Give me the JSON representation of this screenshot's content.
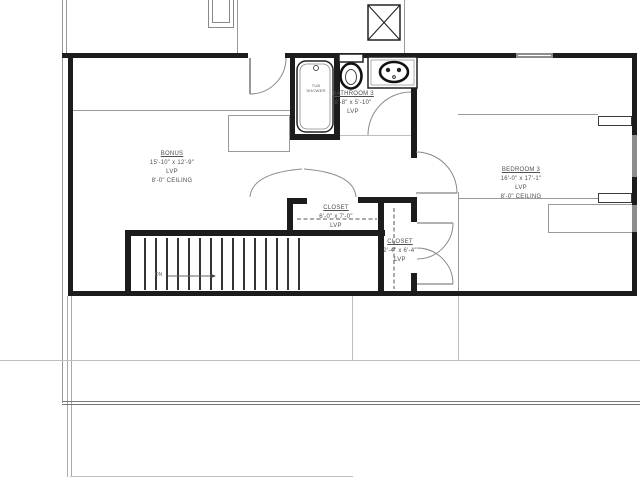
{
  "rooms": [
    {
      "name": "BONUS",
      "dimensions": "15'-10\" x 12'-9\"",
      "flooring": "LVP",
      "ceiling": "8'-0\" CEILING"
    },
    {
      "name": "BATHROOM 3",
      "dimensions": "8'-8\" x 5'-10\"",
      "flooring": "LVP"
    },
    {
      "name": "BEDROOM 3",
      "dimensions": "16'-0\" x 17'-1\"",
      "flooring": "LVP",
      "ceiling": "8'-0\" CEILING"
    },
    {
      "name": "CLOSET",
      "dimensions": "6'-0\" x 7'-0\"",
      "flooring": "LVP"
    },
    {
      "name": "CLOSET",
      "dimensions": "2'-4\" x 6'-4\"",
      "flooring": "LVP"
    }
  ],
  "fixtures": {
    "tub_shower": {
      "label_line1": "TUB",
      "label_line2": "SHOWER"
    }
  },
  "stairs": {
    "direction_label": "DN"
  },
  "colors": {
    "wall": "#1c1c1c",
    "thin_line": "#999999",
    "label_text": "#4f4f4f",
    "dashed_line": "#555555"
  }
}
